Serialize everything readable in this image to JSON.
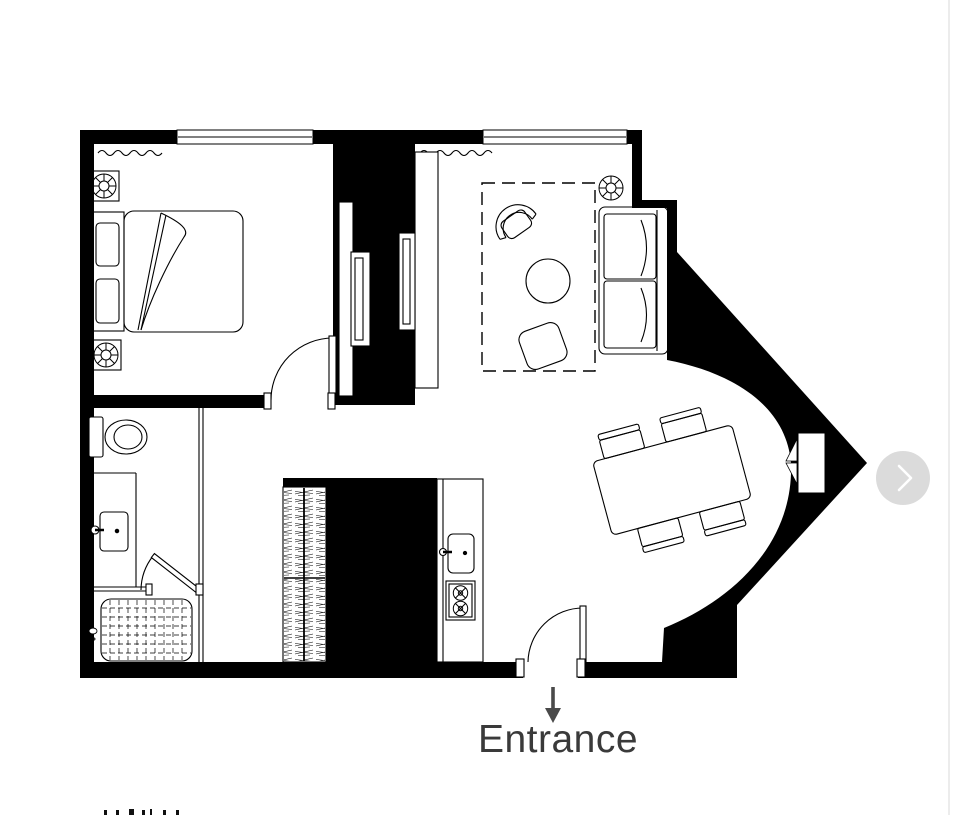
{
  "image": {
    "type": "apartment-floor-plan",
    "entrance_label": "Entrance",
    "colors": {
      "walls": "#000000",
      "furniture_lines": "#000000",
      "entrance_text": "#3a3a3a",
      "entrance_arrow": "#4a4a4a"
    },
    "icons": [
      "bed",
      "pillow",
      "potted-plant",
      "wall-tv",
      "tv-console",
      "curtain-wave",
      "rug",
      "armchair",
      "coffee-table",
      "ottoman",
      "sofa",
      "dining-table",
      "dining-chair",
      "wardrobe",
      "kitchen-counter",
      "kitchen-sink",
      "stove-burners",
      "toilet",
      "vanity-sink",
      "shower",
      "shower-head",
      "door-swing",
      "window",
      "bay-window",
      "entrance-arrow"
    ]
  },
  "carousel": {
    "next_button": {
      "icon": "chevron-right",
      "background": "#dbdbdb",
      "chevron_color": "#ffffff"
    }
  },
  "page": {
    "background": "#ffffff",
    "right_edge_line": "#ececec"
  }
}
